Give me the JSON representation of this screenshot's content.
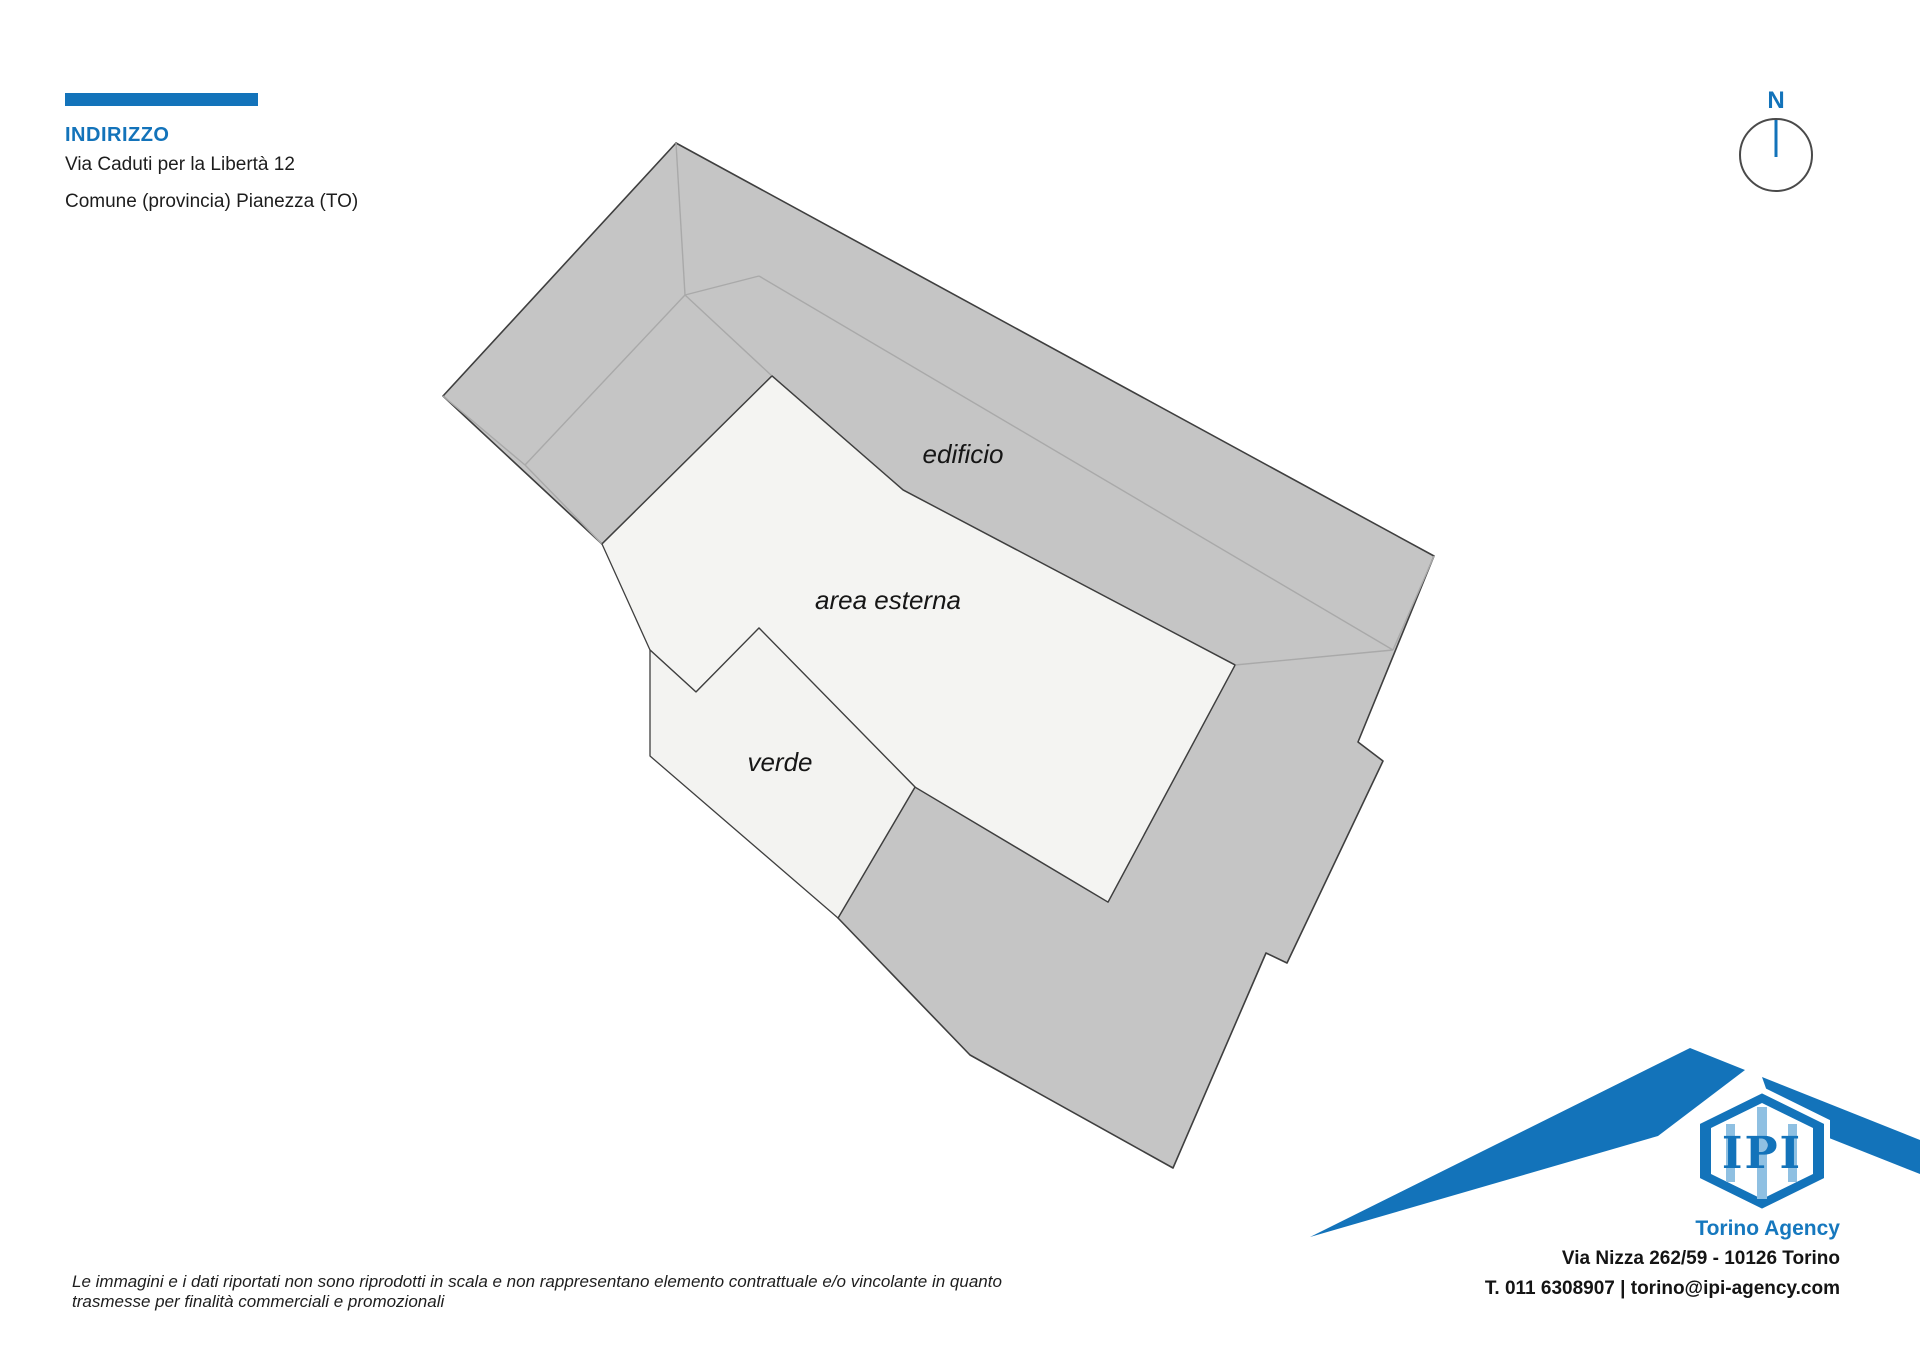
{
  "address": {
    "heading": "INDIRIZZO",
    "line1": "Via Caduti per la Libertà 12",
    "line2": "Comune (provincia) Pianezza (TO)"
  },
  "compass": {
    "label": "N"
  },
  "plan": {
    "labels": {
      "building": "edificio",
      "outdoor": "area esterna",
      "green": "verde"
    },
    "colors": {
      "building_fill": "#c5c5c5",
      "outdoor_fill": "#f4f4f2",
      "green_fill": "#f3f3f1",
      "outline": "#3f3f3f",
      "ridge_line": "#a9a9a9"
    }
  },
  "footer": {
    "disclaimer": "Le immagini e i dati riportati non sono riprodotti in scala e non rappresentano elemento contrattuale e/o vincolante in quanto trasmesse per finalità commerciali e promozionali"
  },
  "agency": {
    "logo_text": "IPI",
    "name": "Torino Agency",
    "address_line": "Via Nizza 262/59 - 10126 Torino",
    "contact_line": "T. 011 6308907 | torino@ipi-agency.com",
    "brand_blue": "#1373ba"
  }
}
